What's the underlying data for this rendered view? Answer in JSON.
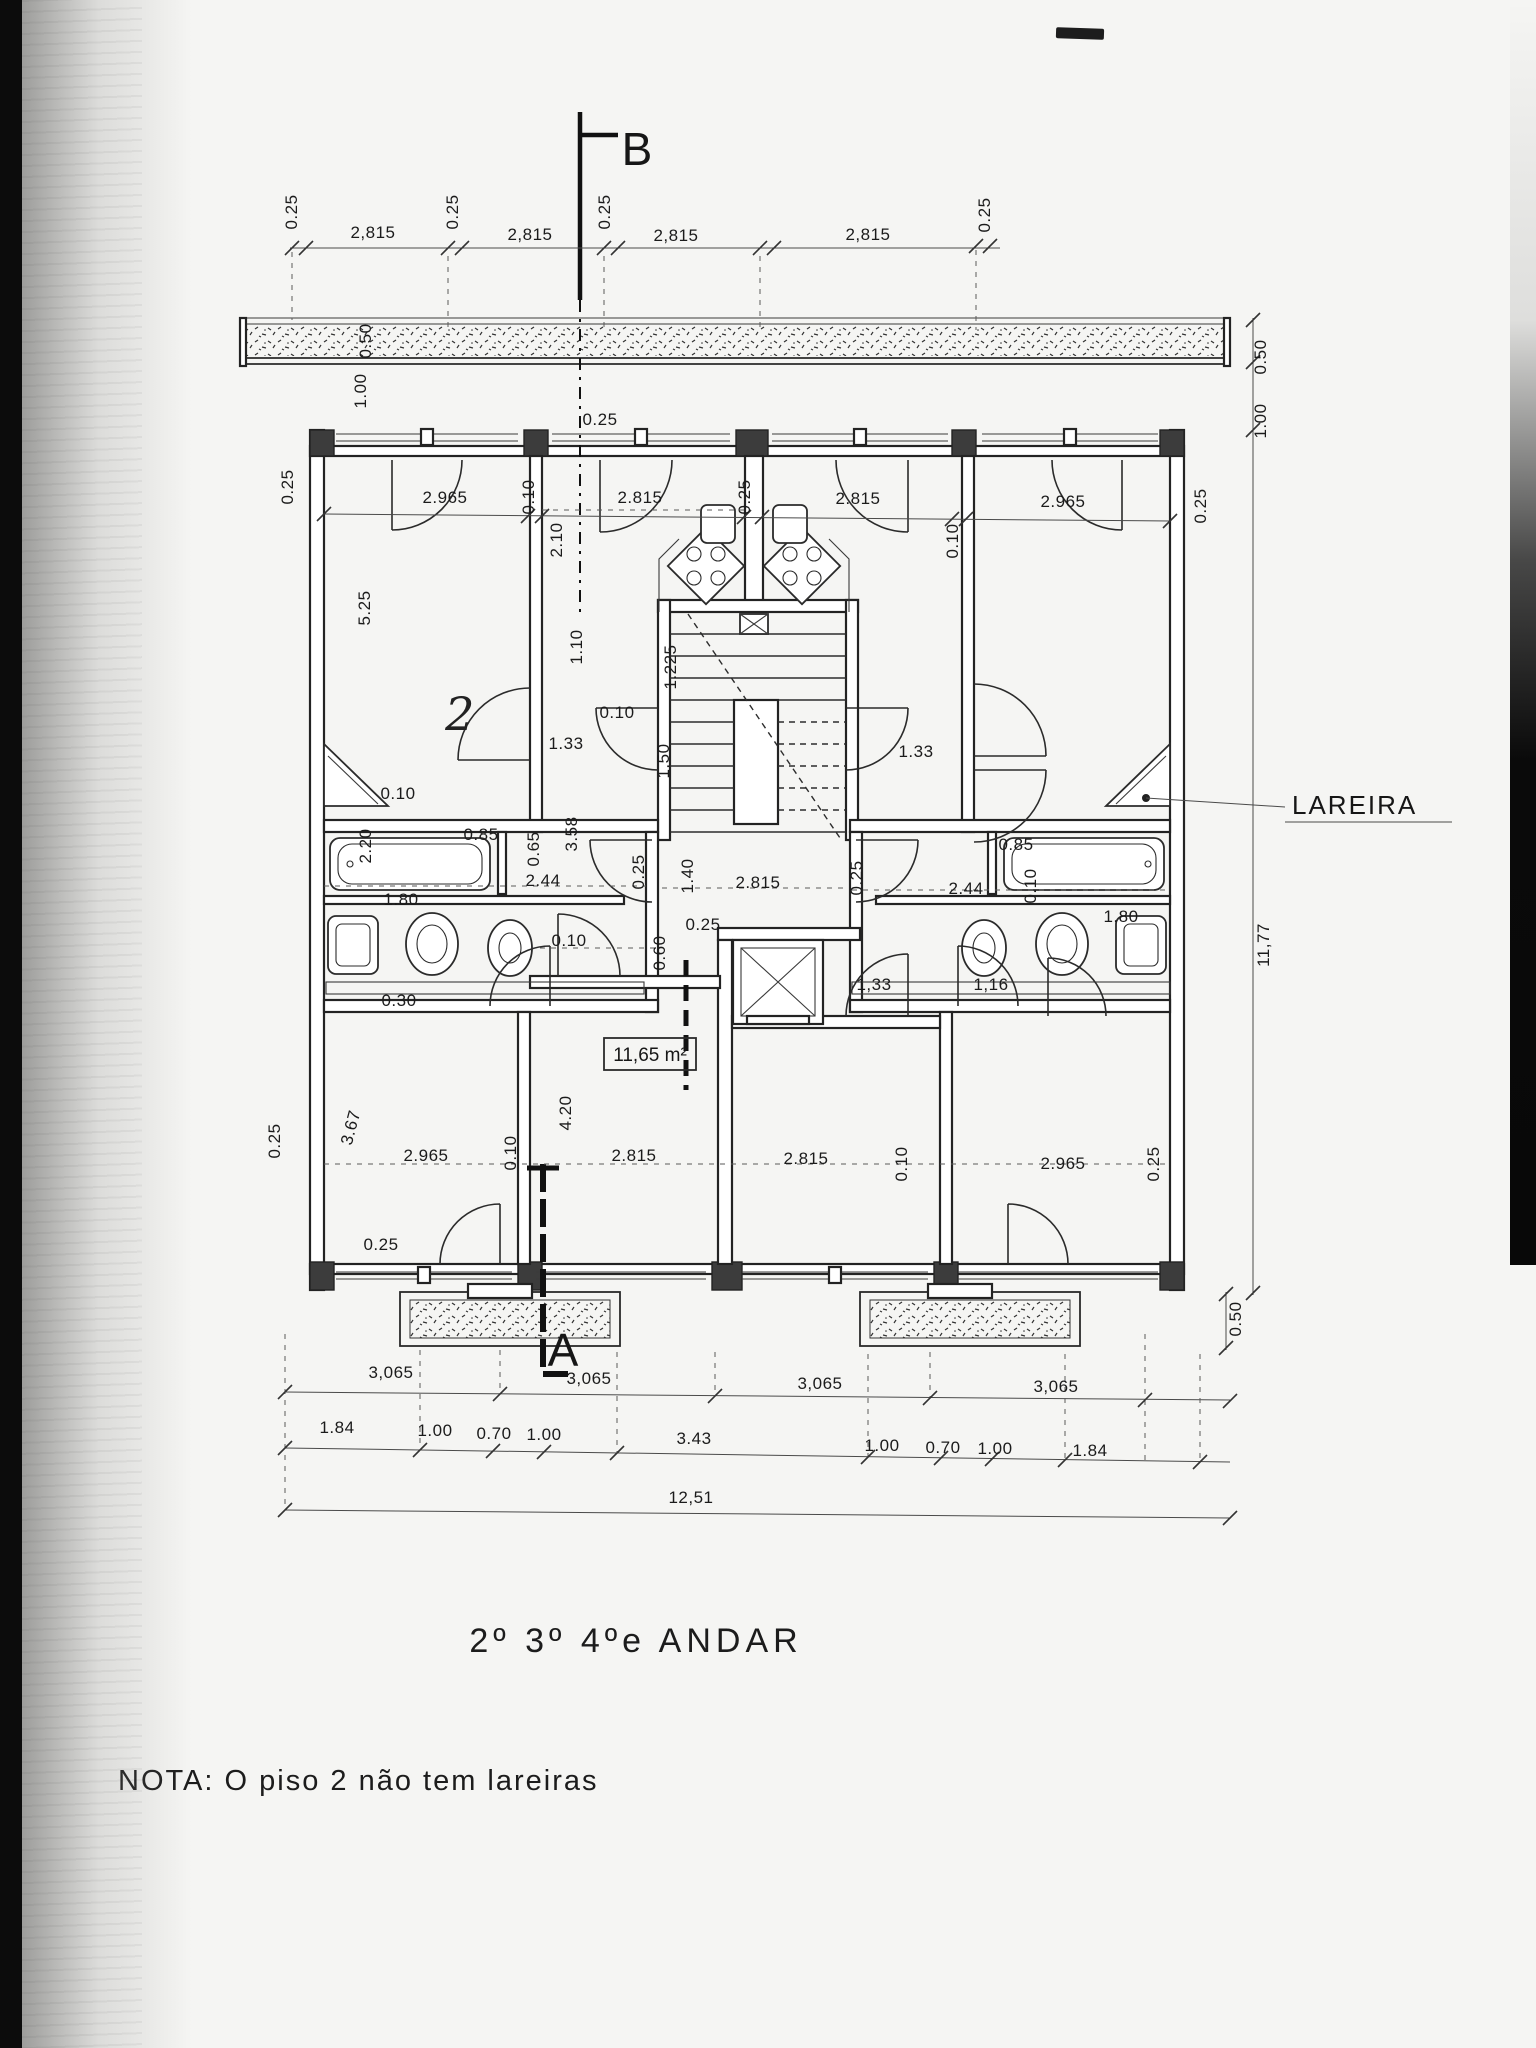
{
  "page": {
    "title": "2º 3º 4ºe ANDAR",
    "note": "NOTA: O  piso 2 não tem lareiras"
  },
  "plan": {
    "section_labels": {
      "a": "A",
      "b": "B"
    },
    "fireplace_label": "LAREIRA",
    "room_area_label": "11,65 m²",
    "dimensions": [
      {
        "t": "0.25",
        "x": 297,
        "y": 212,
        "r": -90
      },
      {
        "t": "2,815",
        "x": 373,
        "y": 238
      },
      {
        "t": "0.25",
        "x": 458,
        "y": 212,
        "r": -90
      },
      {
        "t": "2,815",
        "x": 530,
        "y": 240
      },
      {
        "t": "0.25",
        "x": 610,
        "y": 212,
        "r": -90
      },
      {
        "t": "2,815",
        "x": 676,
        "y": 241
      },
      {
        "t": "2,815",
        "x": 868,
        "y": 240
      },
      {
        "t": "0.25",
        "x": 990,
        "y": 215,
        "r": -90
      },
      {
        "t": "0.50",
        "x": 371,
        "y": 341,
        "r": -90
      },
      {
        "t": "1.00",
        "x": 366,
        "y": 391,
        "r": -90
      },
      {
        "t": "0.25",
        "x": 293,
        "y": 487,
        "r": -90
      },
      {
        "t": "0.25",
        "x": 600,
        "y": 425
      },
      {
        "t": "2.10",
        "x": 562,
        "y": 540,
        "r": -90
      },
      {
        "t": "5.25",
        "x": 370,
        "y": 608,
        "r": -90
      },
      {
        "t": "2.965",
        "x": 445,
        "y": 503
      },
      {
        "t": "0.10",
        "x": 534,
        "y": 497,
        "r": -90
      },
      {
        "t": "2.815",
        "x": 640,
        "y": 503
      },
      {
        "t": "0.25",
        "x": 750,
        "y": 497,
        "r": -90
      },
      {
        "t": "2.815",
        "x": 858,
        "y": 504
      },
      {
        "t": "0.10",
        "x": 958,
        "y": 541,
        "r": -90
      },
      {
        "t": "2.965",
        "x": 1063,
        "y": 507
      },
      {
        "t": "0.50",
        "x": 1266,
        "y": 357,
        "r": -90
      },
      {
        "t": "1.00",
        "x": 1266,
        "y": 421,
        "r": -90
      },
      {
        "t": "0.25",
        "x": 1206,
        "y": 506,
        "r": -90
      },
      {
        "t": "1.10",
        "x": 582,
        "y": 647,
        "r": -90
      },
      {
        "t": "1.225",
        "x": 676,
        "y": 667,
        "r": -90
      },
      {
        "t": "0.10",
        "x": 617,
        "y": 718
      },
      {
        "t": "1.33",
        "x": 566,
        "y": 749
      },
      {
        "t": "1.50",
        "x": 669,
        "y": 761,
        "r": -90
      },
      {
        "t": "1.33",
        "x": 916,
        "y": 757
      },
      {
        "t": "2",
        "x": 460,
        "y": 730,
        "s": "hand"
      },
      {
        "t": "0.10",
        "x": 398,
        "y": 799
      },
      {
        "t": "2.20",
        "x": 371,
        "y": 846,
        "r": -90
      },
      {
        "t": "0.85",
        "x": 481,
        "y": 840
      },
      {
        "t": "0.65",
        "x": 539,
        "y": 849,
        "r": -90
      },
      {
        "t": "2.44",
        "x": 543,
        "y": 886
      },
      {
        "t": "3.58",
        "x": 577,
        "y": 834,
        "r": -90
      },
      {
        "t": "1.80",
        "x": 401,
        "y": 905
      },
      {
        "t": "0.30",
        "x": 399,
        "y": 1006
      },
      {
        "t": "0.25",
        "x": 644,
        "y": 872,
        "r": -90
      },
      {
        "t": "0.10",
        "x": 569,
        "y": 946
      },
      {
        "t": "0.60",
        "x": 665,
        "y": 953,
        "r": -90
      },
      {
        "t": "0.25",
        "x": 703,
        "y": 930
      },
      {
        "t": "1.40",
        "x": 693,
        "y": 876,
        "r": -90
      },
      {
        "t": "2.815",
        "x": 758,
        "y": 888
      },
      {
        "t": "0.25",
        "x": 862,
        "y": 878,
        "r": -90
      },
      {
        "t": "0.85",
        "x": 1016,
        "y": 850
      },
      {
        "t": "2.44",
        "x": 966,
        "y": 894
      },
      {
        "t": "0.10",
        "x": 1036,
        "y": 886,
        "r": -90
      },
      {
        "t": "1.80",
        "x": 1121,
        "y": 922
      },
      {
        "t": "11,77",
        "x": 1269,
        "y": 945,
        "r": -90
      },
      {
        "t": "1,33",
        "x": 874,
        "y": 990
      },
      {
        "t": "1,16",
        "x": 991,
        "y": 990
      },
      {
        "t": "0.25",
        "x": 280,
        "y": 1141,
        "r": -90
      },
      {
        "t": "3.67",
        "x": 356,
        "y": 1129,
        "r": -75
      },
      {
        "t": "2.965",
        "x": 426,
        "y": 1161
      },
      {
        "t": "0.10",
        "x": 516,
        "y": 1153,
        "r": -90
      },
      {
        "t": "4.20",
        "x": 571,
        "y": 1113,
        "r": -90
      },
      {
        "t": "2.815",
        "x": 634,
        "y": 1161
      },
      {
        "t": "2.815",
        "x": 806,
        "y": 1164
      },
      {
        "t": "0.10",
        "x": 907,
        "y": 1164,
        "r": -90
      },
      {
        "t": "2.965",
        "x": 1063,
        "y": 1169
      },
      {
        "t": "0.25",
        "x": 1159,
        "y": 1164,
        "r": -90
      },
      {
        "t": "0.25",
        "x": 381,
        "y": 1250
      },
      {
        "t": "0.50",
        "x": 1241,
        "y": 1319,
        "r": -90
      },
      {
        "t": "3,065",
        "x": 391,
        "y": 1378
      },
      {
        "t": "3,065",
        "x": 589,
        "y": 1384
      },
      {
        "t": "3,065",
        "x": 820,
        "y": 1389
      },
      {
        "t": "3,065",
        "x": 1056,
        "y": 1392
      },
      {
        "t": "1.84",
        "x": 337,
        "y": 1433
      },
      {
        "t": "1.00",
        "x": 435,
        "y": 1436
      },
      {
        "t": "0.70",
        "x": 494,
        "y": 1439
      },
      {
        "t": "1.00",
        "x": 544,
        "y": 1440
      },
      {
        "t": "3.43",
        "x": 694,
        "y": 1444
      },
      {
        "t": "1.00",
        "x": 882,
        "y": 1451
      },
      {
        "t": "0.70",
        "x": 943,
        "y": 1453
      },
      {
        "t": "1.00",
        "x": 995,
        "y": 1454
      },
      {
        "t": "1.84",
        "x": 1090,
        "y": 1456
      },
      {
        "t": "12,51",
        "x": 691,
        "y": 1503
      }
    ]
  }
}
